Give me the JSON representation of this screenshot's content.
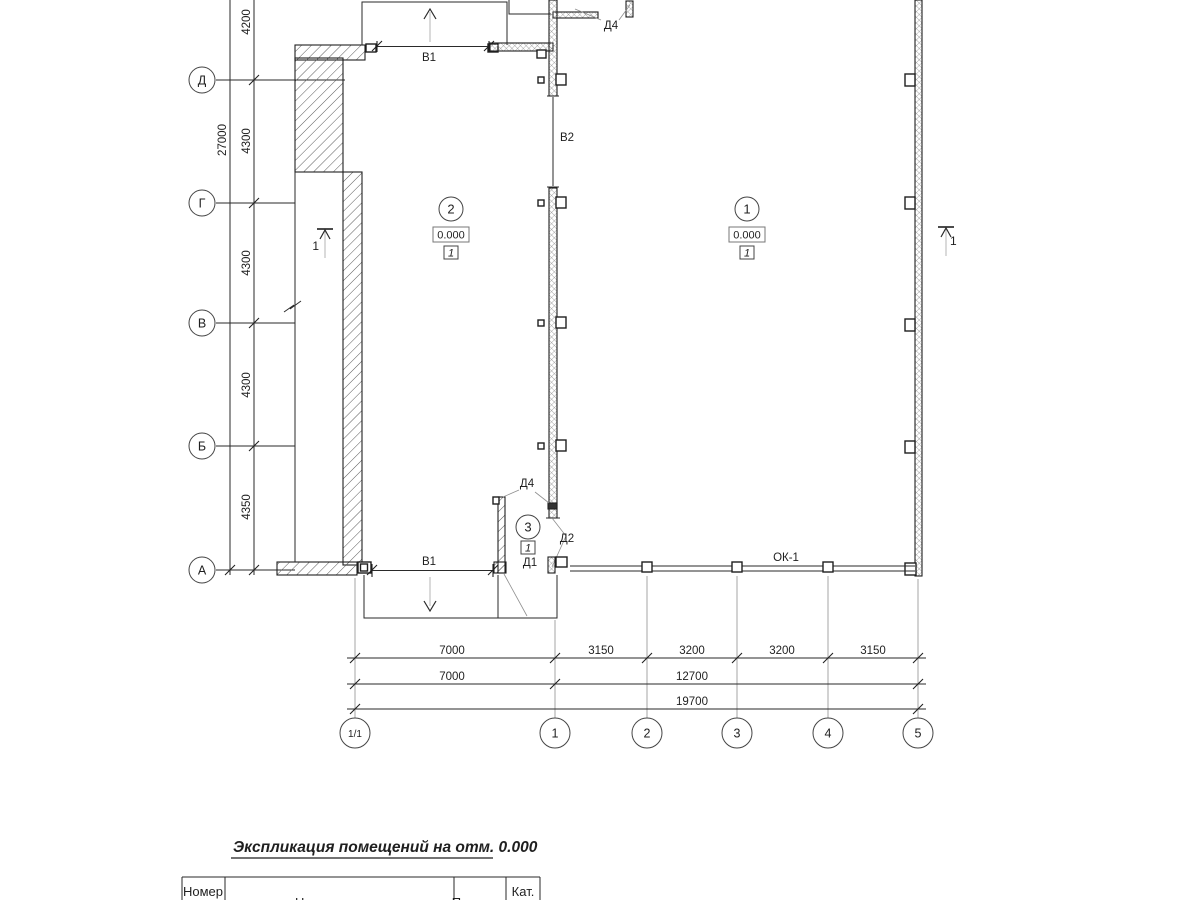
{
  "axes": {
    "rows": [
      {
        "label": "Д"
      },
      {
        "label": "Г"
      },
      {
        "label": "В"
      },
      {
        "label": "Б"
      },
      {
        "label": "А"
      }
    ],
    "cols": [
      {
        "label": "1/1"
      },
      {
        "label": "1"
      },
      {
        "label": "2"
      },
      {
        "label": "3"
      },
      {
        "label": "4"
      },
      {
        "label": "5"
      }
    ]
  },
  "dims": {
    "left": [
      "4200",
      "4300",
      "4300",
      "4300",
      "4350"
    ],
    "left_total": "27000",
    "bottom_row1": [
      "7000",
      "3150",
      "3200",
      "3200",
      "3150"
    ],
    "bottom_row2": [
      "7000",
      "12700"
    ],
    "bottom_row3": [
      "19700"
    ]
  },
  "rooms": [
    {
      "number": "2",
      "elevation": "0.000",
      "category": "1"
    },
    {
      "number": "1",
      "elevation": "0.000",
      "category": "1"
    },
    {
      "number": "3",
      "category": "1"
    }
  ],
  "labels": {
    "gate_top": "В1",
    "gate_bottom": "В1",
    "gate_interior": "В2",
    "door_d4_top": "Д4",
    "door_d4_vestibule": "Д4",
    "door_d2": "Д2",
    "door_d1": "Д1",
    "window": "ОК-1"
  },
  "sections": {
    "left": "1",
    "right": "1"
  },
  "schedule": {
    "title": "Экспликация помещений на отм. 0.000",
    "headers": {
      "number": "Номер",
      "name": "Наименование",
      "area": "Площадь",
      "category": "Кат."
    }
  }
}
